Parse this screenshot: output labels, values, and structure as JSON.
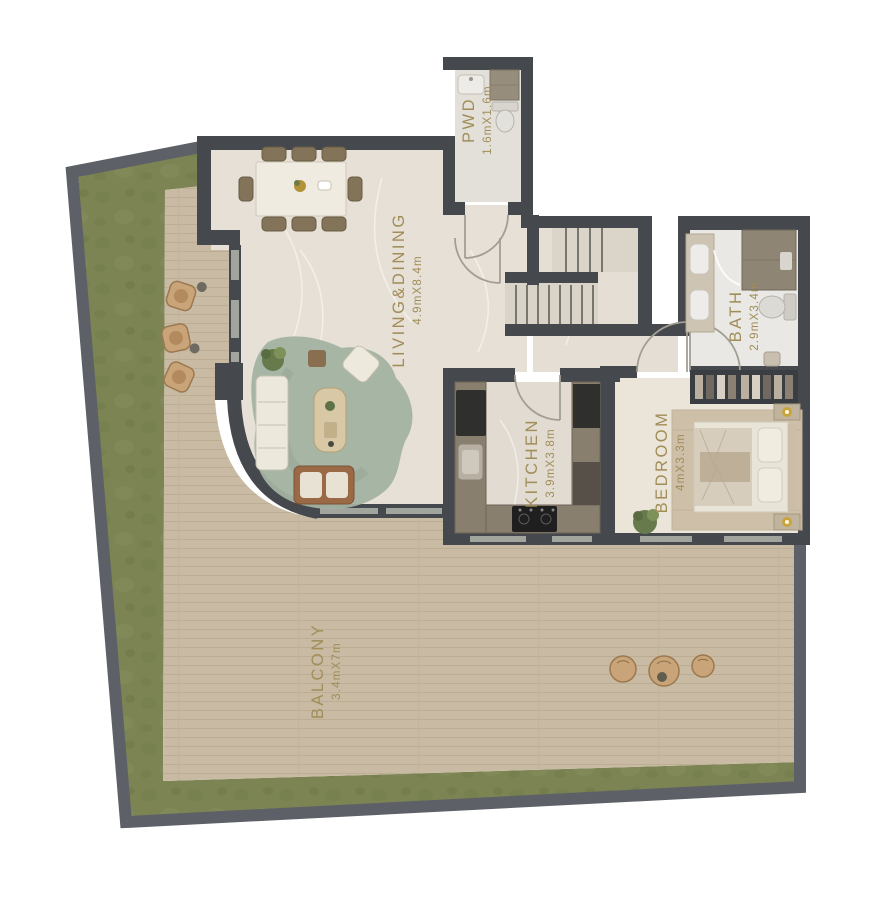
{
  "plan_title": "apartment-floor-plan",
  "rooms": [
    {
      "key": "pwd",
      "name": "PWD",
      "dims": "1.6mX1.6m"
    },
    {
      "key": "living-dining",
      "name": "LIVING&DINING",
      "dims": "4.9mX8.4m"
    },
    {
      "key": "bath",
      "name": "BATH",
      "dims": "2.9mX3.4m"
    },
    {
      "key": "kitchen",
      "name": "KITCHEN",
      "dims": "3.9mX3.8m"
    },
    {
      "key": "bedroom",
      "name": "BEDROOM",
      "dims": "4mX3.3m"
    },
    {
      "key": "balcony",
      "name": "BALCONY",
      "dims": "3.4mX7m"
    }
  ],
  "colors": {
    "label_text": "#a08d58",
    "wall_interior": "#45484d",
    "wall_exterior": "#5d6167",
    "grass": "#7c8454",
    "deck_wood": "#c9bba3",
    "marble_floor": "#e7e0d6",
    "living_rug": "#a3b2a2",
    "sofa_brown": "#9a6a47",
    "counter_taupe": "#897f6f",
    "lamp_gold": "#c9a43c"
  }
}
